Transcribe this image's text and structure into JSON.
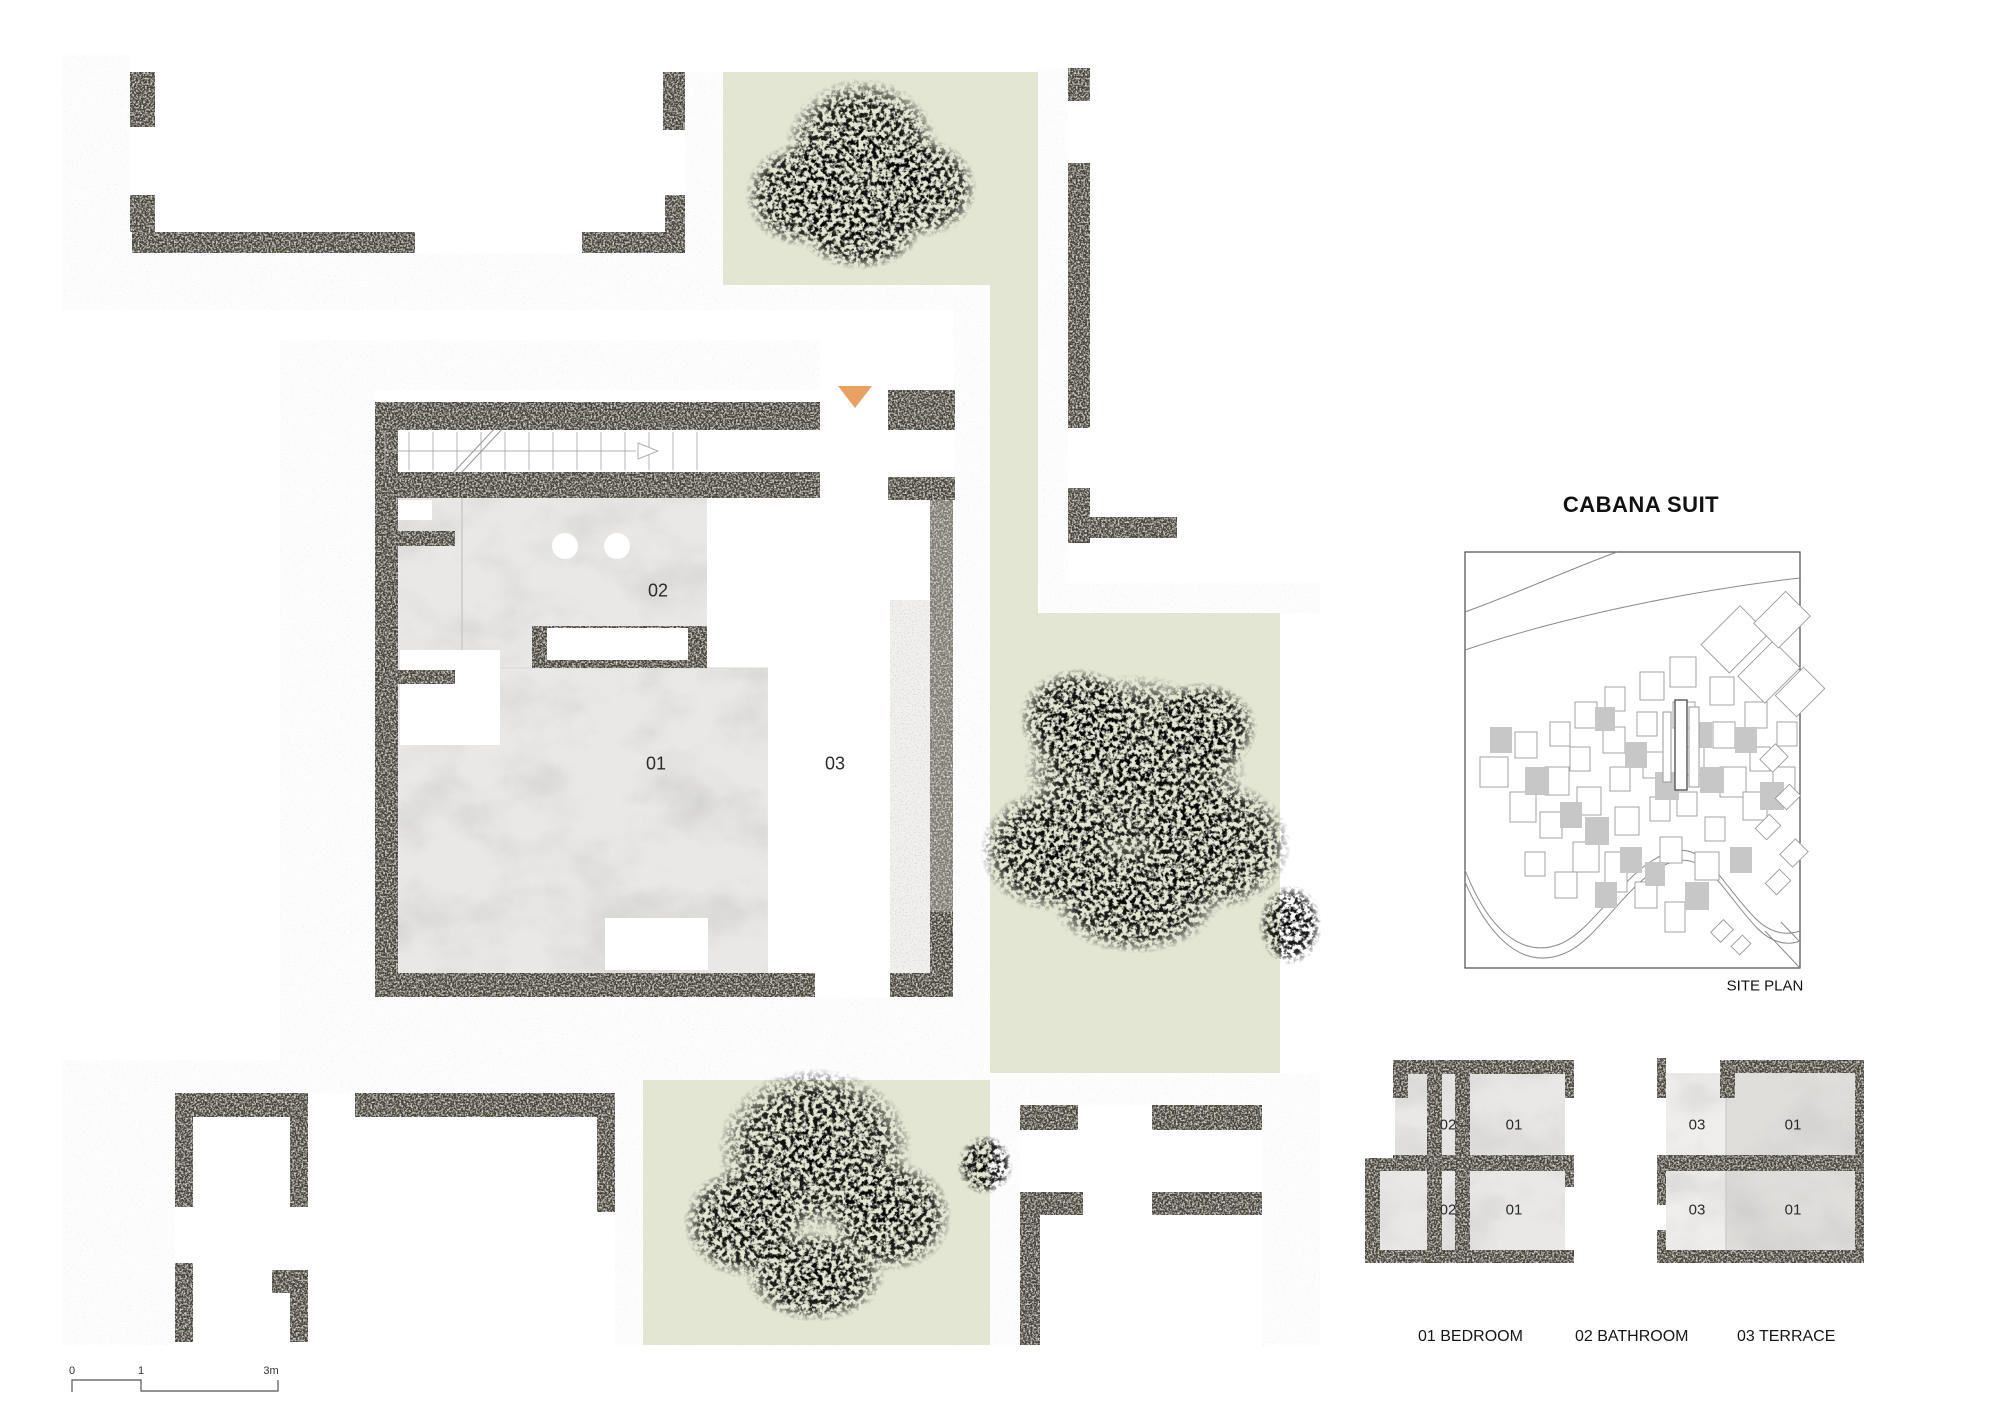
{
  "title": "CABANA SUIT",
  "site_plan": {
    "caption": "SITE PLAN"
  },
  "floor_plan": {
    "labels": {
      "bathroom": "02",
      "bedroom": "01",
      "terrace": "03"
    }
  },
  "unit_diagrams": {
    "left_unit": {
      "rooms": [
        "02",
        "01",
        "02",
        "01"
      ]
    },
    "right_unit": {
      "rooms": [
        "03",
        "01",
        "03",
        "01"
      ]
    }
  },
  "legend": {
    "items": [
      "01 BEDROOM",
      "02 BATHROOM",
      "03 TERRACE"
    ]
  },
  "scale_bar": {
    "ticks": [
      "0",
      "1",
      "3m"
    ]
  },
  "colors": {
    "entrance_marker": "#E8A163",
    "wall": "#474239",
    "greenery": "#E4E6D4",
    "marble_floor": "#E9E8E6"
  }
}
